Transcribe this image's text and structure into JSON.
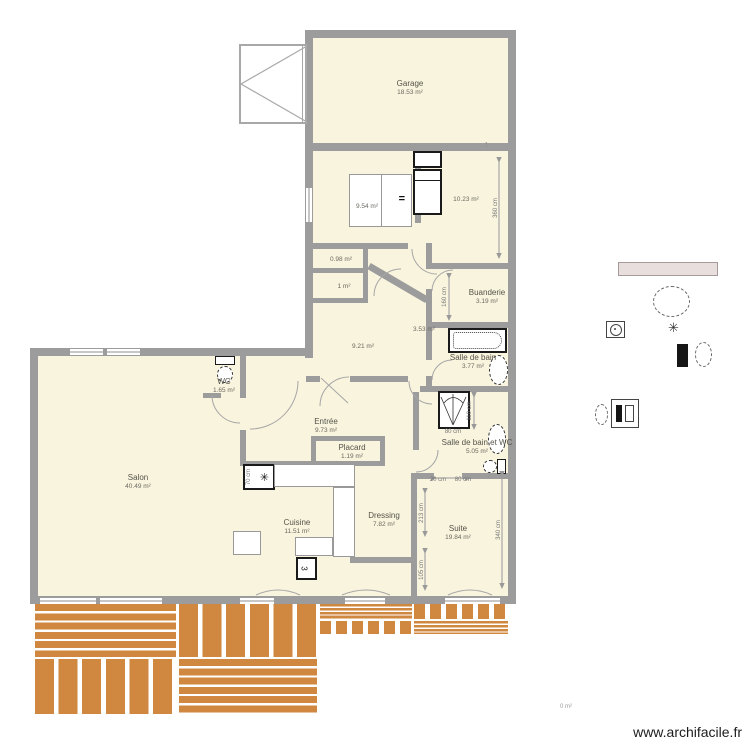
{
  "site": {
    "watermark": "www.archifacile.fr",
    "stray_area_label": "0 m²"
  },
  "colors": {
    "wall": "#9c9c9c",
    "room_floor": "#f8f4de",
    "terrace_plank": "#d0873f",
    "furniture_outline": "#1a1a1a",
    "dimension_text": "#777777",
    "shelf_bar_fill": "#e8dede"
  },
  "icons": {
    "snowflake": "✳",
    "north_arrow": "↑",
    "stove_glyph": "3",
    "desk_equals": "="
  },
  "rooms": [
    {
      "name": "Garage",
      "area": "18.53 m²",
      "x": 410,
      "y": 88
    },
    {
      "name": "",
      "area": "9.54 m²",
      "x": 367,
      "y": 207
    },
    {
      "name": "",
      "area": "10.23 m²",
      "x": 466,
      "y": 200
    },
    {
      "name": "",
      "area": "0.98 m²",
      "x": 341,
      "y": 260
    },
    {
      "name": "",
      "area": "1 m²",
      "x": 344,
      "y": 287
    },
    {
      "name": "Buanderie",
      "area": "3.19 m²",
      "x": 487,
      "y": 297
    },
    {
      "name": "",
      "area": "3.53 m²",
      "x": 424,
      "y": 330
    },
    {
      "name": "",
      "area": "9.21 m²",
      "x": 363,
      "y": 347
    },
    {
      "name": "Salle de bain",
      "area": "3.77 m²",
      "x": 473,
      "y": 362
    },
    {
      "name": "WC",
      "area": "1.65 m²",
      "x": 224,
      "y": 386
    },
    {
      "name": "Entrée",
      "area": "9.73 m²",
      "x": 326,
      "y": 426
    },
    {
      "name": "Placard",
      "area": "1.19 m²",
      "x": 352,
      "y": 452
    },
    {
      "name": "Salle de bain et WC",
      "area": "5.05 m²",
      "x": 477,
      "y": 447
    },
    {
      "name": "Salon",
      "area": "40.49 m²",
      "x": 138,
      "y": 482
    },
    {
      "name": "Cuisine",
      "area": "11.51 m²",
      "x": 297,
      "y": 527
    },
    {
      "name": "Dressing",
      "area": "7.82 m²",
      "x": 384,
      "y": 520
    },
    {
      "name": "Suite",
      "area": "19.84 m²",
      "x": 458,
      "y": 533
    }
  ],
  "dimensions": [
    {
      "text": "360 cm",
      "x": 496,
      "y": 208,
      "rot": true
    },
    {
      "text": "160 cm",
      "x": 445,
      "y": 297,
      "rot": true
    },
    {
      "text": "110 cm",
      "x": 470,
      "y": 411,
      "rot": true
    },
    {
      "text": "80 cm",
      "x": 453,
      "y": 432,
      "rot": false
    },
    {
      "text": "20 cm",
      "x": 438,
      "y": 480,
      "rot": false
    },
    {
      "text": "80 cm",
      "x": 463,
      "y": 480,
      "rot": false
    },
    {
      "text": "213 cm",
      "x": 422,
      "y": 513,
      "rot": true
    },
    {
      "text": "105 cm",
      "x": 422,
      "y": 570,
      "rot": true
    },
    {
      "text": "340 cm",
      "x": 499,
      "y": 530,
      "rot": true
    },
    {
      "text": "70 cm",
      "x": 249,
      "y": 477,
      "rot": true
    }
  ]
}
